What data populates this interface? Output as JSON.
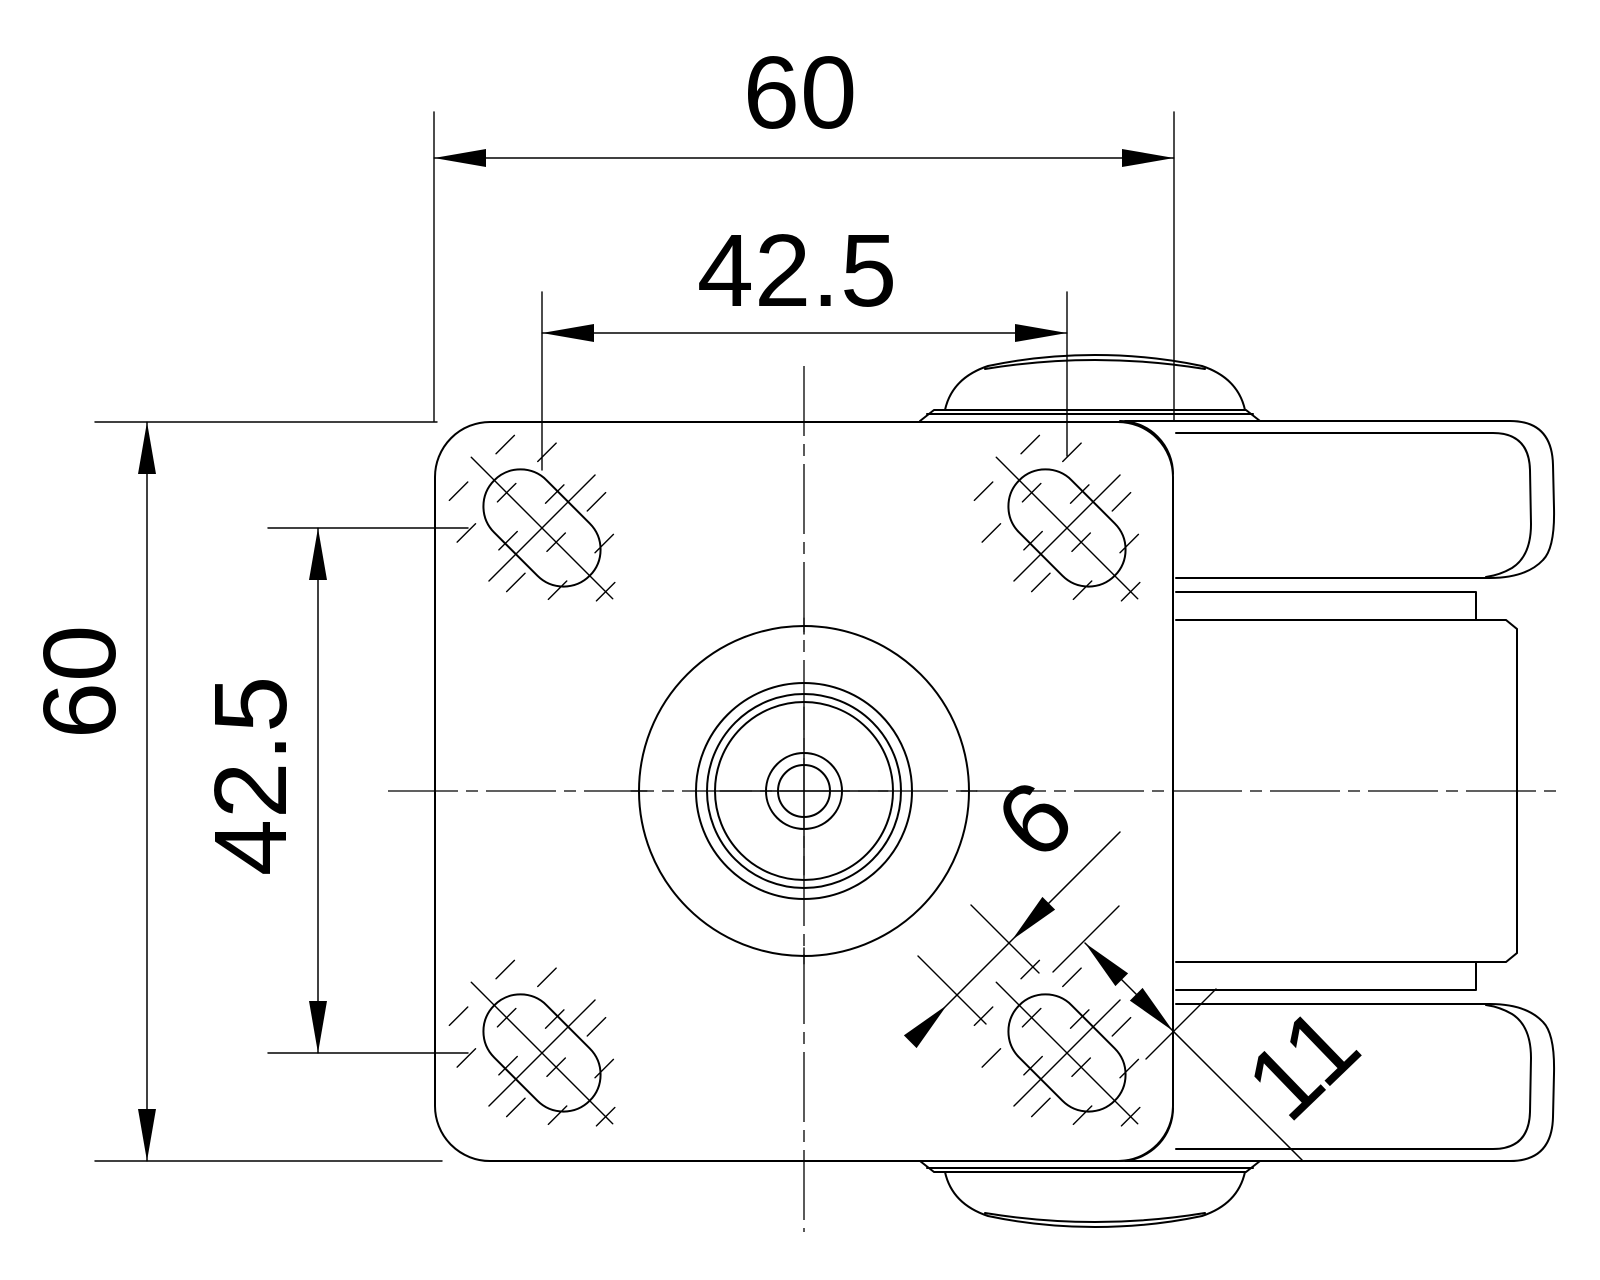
{
  "drawing": {
    "type": "caster-wheel-top-view-technical-drawing",
    "background_color": "#ffffff",
    "line_color": "#000000"
  },
  "dimensions": {
    "plate_width": "60",
    "bolt_spacing_horizontal": "42.5",
    "plate_height": "60",
    "bolt_spacing_vertical": "42.5",
    "slot_width": "6",
    "slot_length": "11"
  }
}
